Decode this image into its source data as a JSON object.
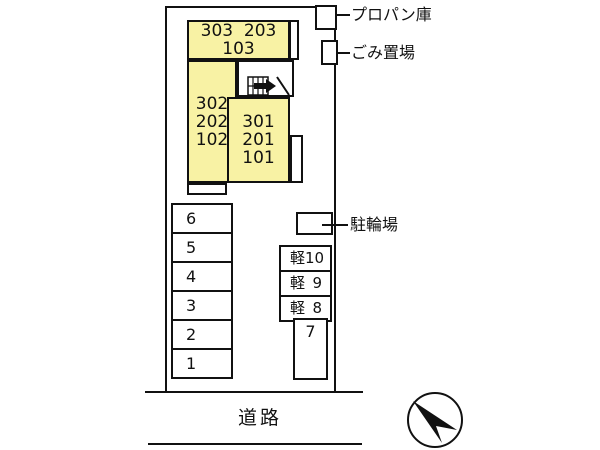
{
  "plan": {
    "building": {
      "top_unit_line1": "303  203",
      "top_unit_line2": "103",
      "left_units": [
        "302",
        "202",
        "102"
      ],
      "right_units": [
        "301",
        "201",
        "101"
      ]
    },
    "facilities": {
      "propane": "プロパン庫",
      "garbage": "ごみ置場",
      "bicycle": "駐輪場"
    },
    "parking": {
      "left_column": [
        "6",
        "5",
        "4",
        "3",
        "2",
        "1"
      ],
      "kei_spaces": [
        {
          "prefix": "軽",
          "number": "10"
        },
        {
          "prefix": "軽",
          "number": "9"
        },
        {
          "prefix": "軽",
          "number": "8"
        }
      ],
      "space_7": "7"
    },
    "road": "道路"
  },
  "colors": {
    "unit_fill": "#F8F2A4",
    "line": "#111111",
    "background": "#FFFFFF"
  }
}
